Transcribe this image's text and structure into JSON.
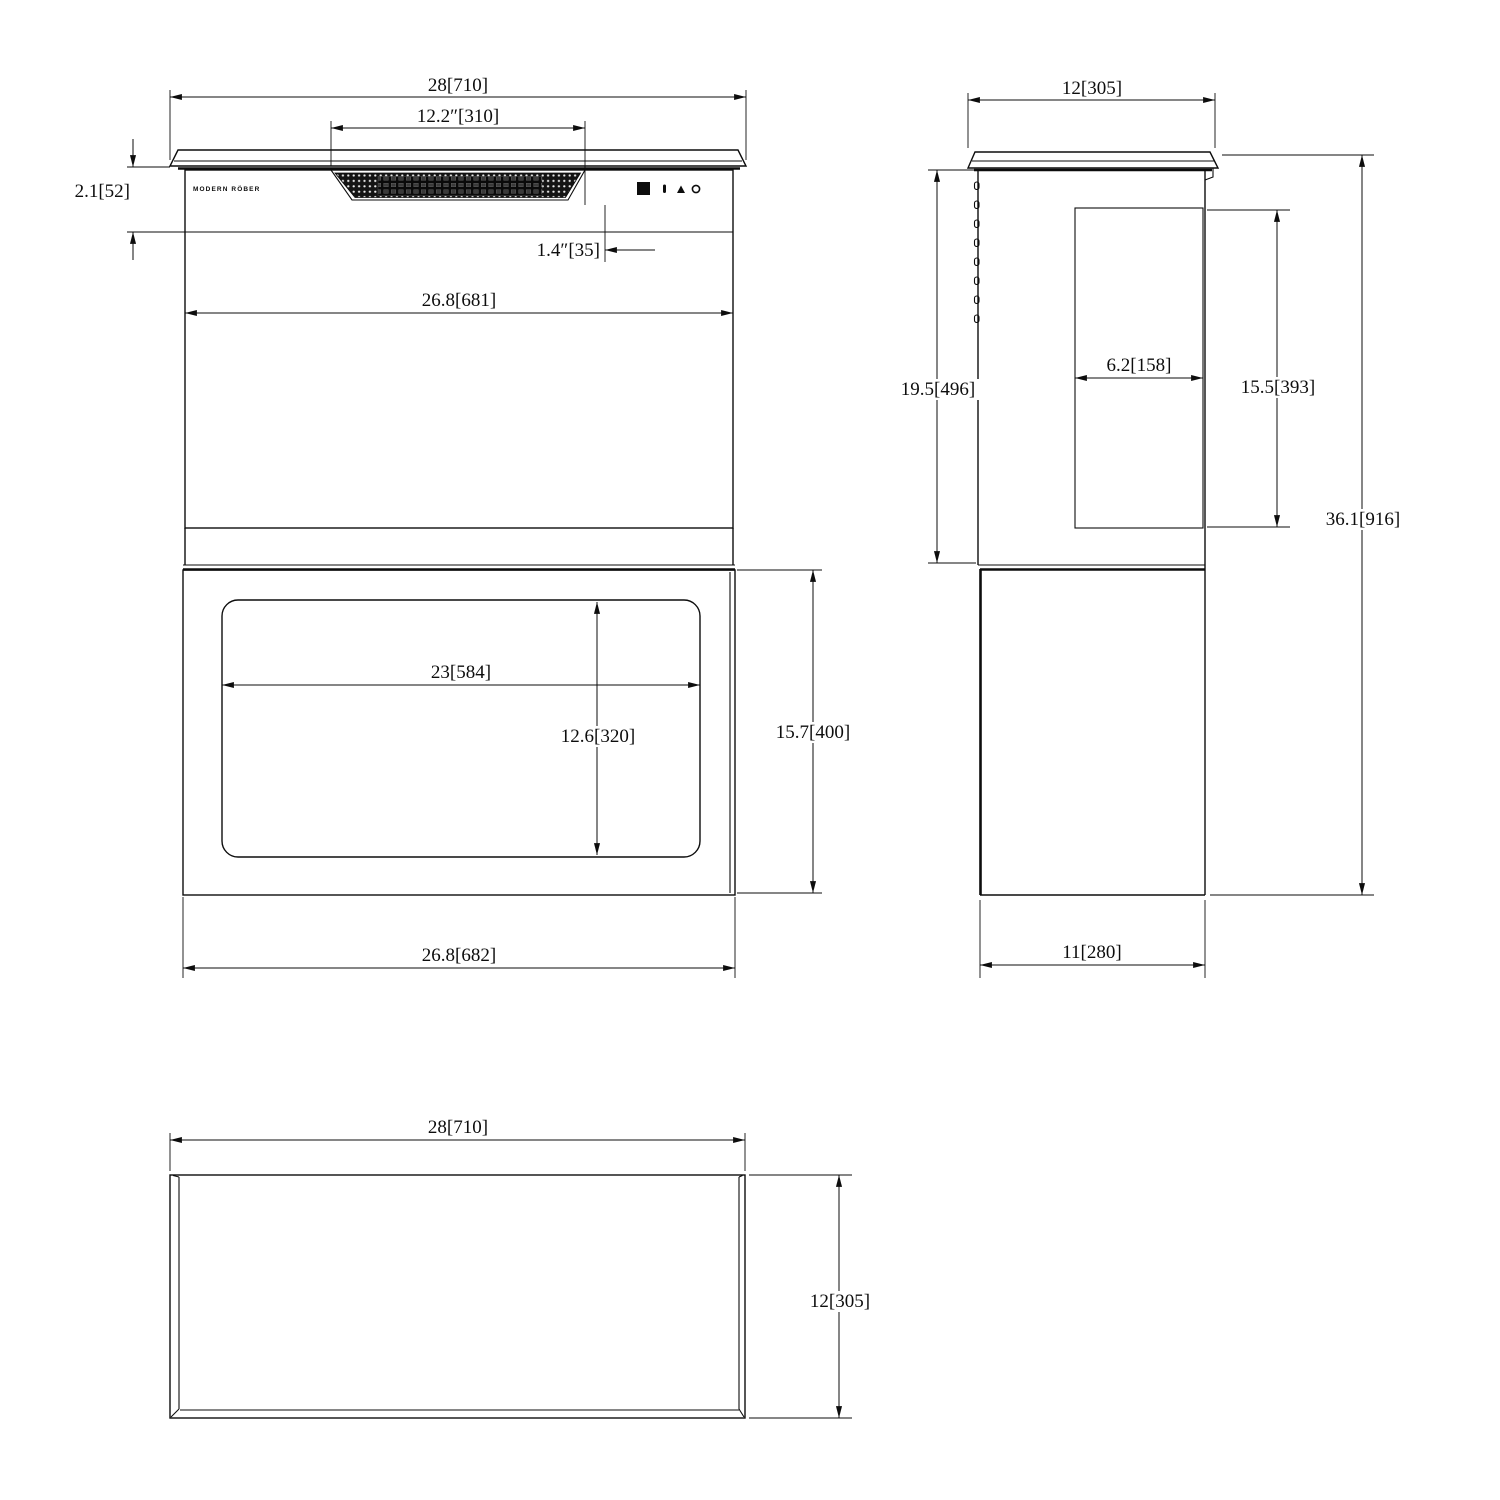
{
  "brand": "MODERN RÖBER",
  "front": {
    "total_width": "28[710]",
    "vent_width": "12.2″[310]",
    "control_height": "2.1[52]",
    "vent_offset": "1.4″[35]",
    "upper_width": "26.8[681]",
    "window_width": "23[584]",
    "window_height": "12.6[320]",
    "lower_height": "15.7[400]",
    "lower_width": "26.8[682]"
  },
  "side": {
    "top_depth": "12[305]",
    "upper_height": "19.5[496]",
    "duct_depth": "6.2[158]",
    "duct_height": "15.5[393]",
    "total_height": "36.1[916]",
    "bottom_depth": "11[280]"
  },
  "top": {
    "width": "28[710]",
    "depth": "12[305]"
  }
}
